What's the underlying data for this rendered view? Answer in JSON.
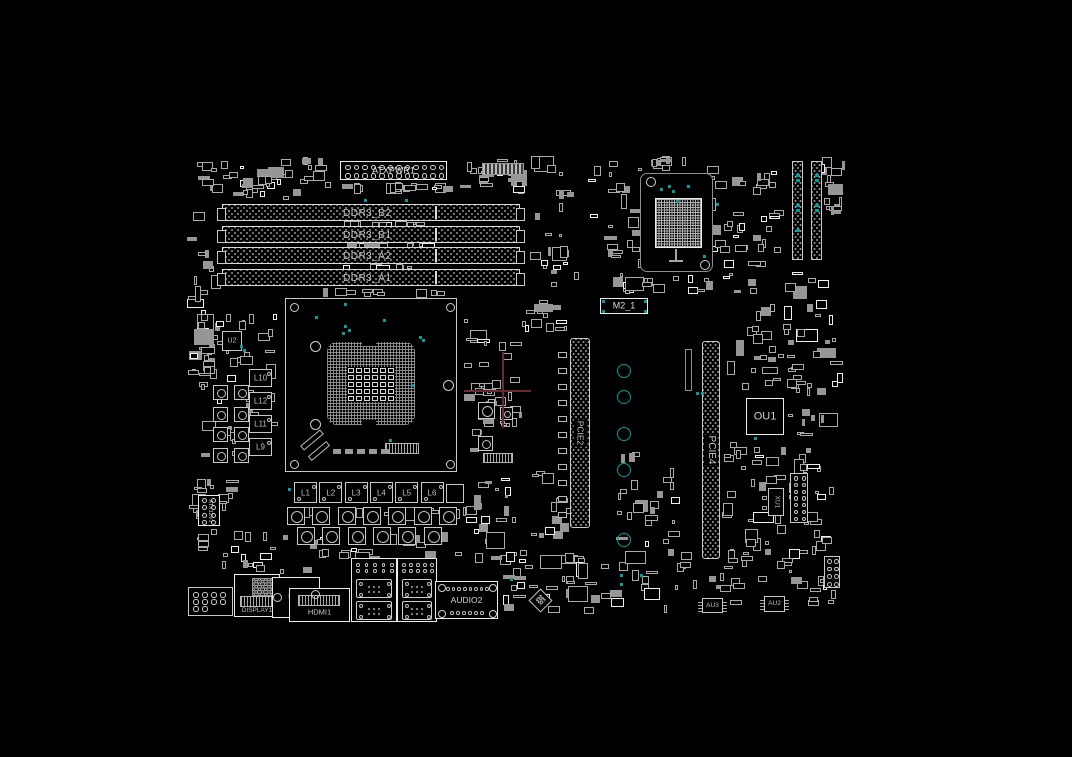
{
  "colors": {
    "background": "#000000",
    "component_outline": "#c8c8c8",
    "bright_outline": "#ececec",
    "pad_fill": "#969696",
    "teal_accent": "#009e9e",
    "crosshair": "#6b2733",
    "label_text": "#c9c9c9"
  },
  "board": {
    "power": {
      "atx": "ATXPWR1",
      "atx12v": "ATX12V1"
    },
    "memory": {
      "slots": [
        "DDR3_B2",
        "DDR3_B1",
        "DDR3_A2",
        "DDR3_A1"
      ]
    },
    "pcie": {
      "slot2": "PCIE2",
      "slot4": "PCIE4"
    },
    "storage": {
      "m2": "M2_1"
    },
    "chips": {
      "ou1": "OU1",
      "xu1": "XU1",
      "u2": "U2",
      "au2": "AU2",
      "au3": "AU3"
    },
    "inductors": {
      "bottom": [
        "L1",
        "L2",
        "L3",
        "L4",
        "L5",
        "L6"
      ],
      "left": [
        "L10",
        "L12",
        "L11",
        "L9"
      ]
    },
    "rear_io": {
      "display": "DISPLAY1",
      "dvi": "DVI1",
      "hdmi": "HDMI1",
      "audio": "AUDIO2"
    }
  }
}
